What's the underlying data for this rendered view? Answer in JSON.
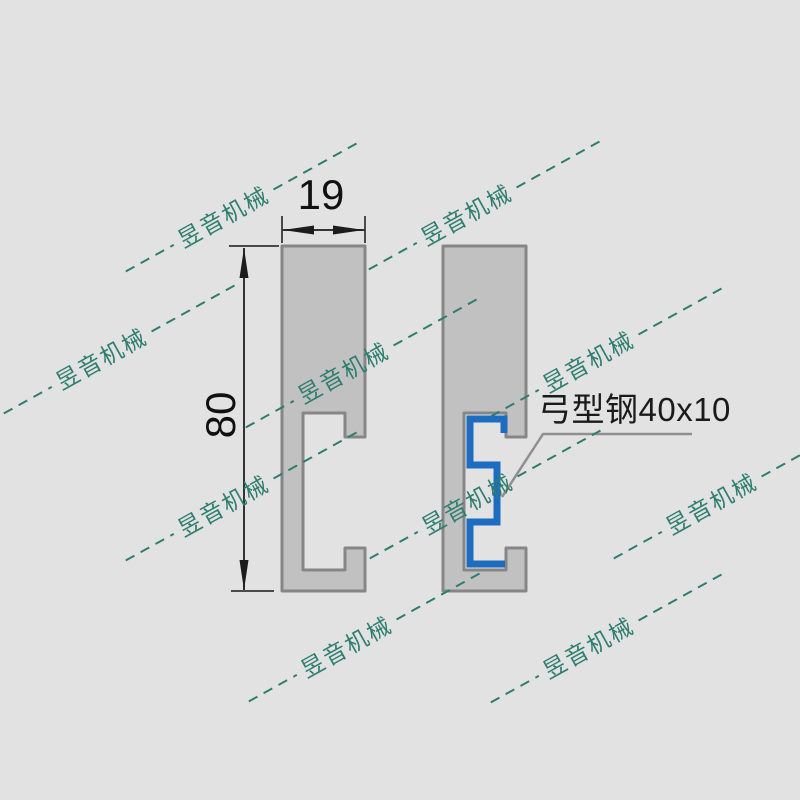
{
  "drawing": {
    "dim_width": {
      "value": "19"
    },
    "dim_height": {
      "value": "80"
    },
    "label": {
      "text": "弓型钢40x10"
    },
    "colors": {
      "background": "#e2e2e2",
      "highlight_blue": "#1d6cc0",
      "watermark_teal": "#2e7e6f",
      "profile_fill": "#c1c1c1",
      "profile_stroke": "#868686"
    }
  },
  "watermark": {
    "text": "昱音机械",
    "positions": [
      {
        "x": 242,
        "y": 207
      },
      {
        "x": 485,
        "y": 205
      },
      {
        "x": 120,
        "y": 349
      },
      {
        "x": 362,
        "y": 363
      },
      {
        "x": 607,
        "y": 352
      },
      {
        "x": 242,
        "y": 496
      },
      {
        "x": 486,
        "y": 494
      },
      {
        "x": 730,
        "y": 494
      },
      {
        "x": 365,
        "y": 637
      },
      {
        "x": 607,
        "y": 638
      }
    ]
  }
}
